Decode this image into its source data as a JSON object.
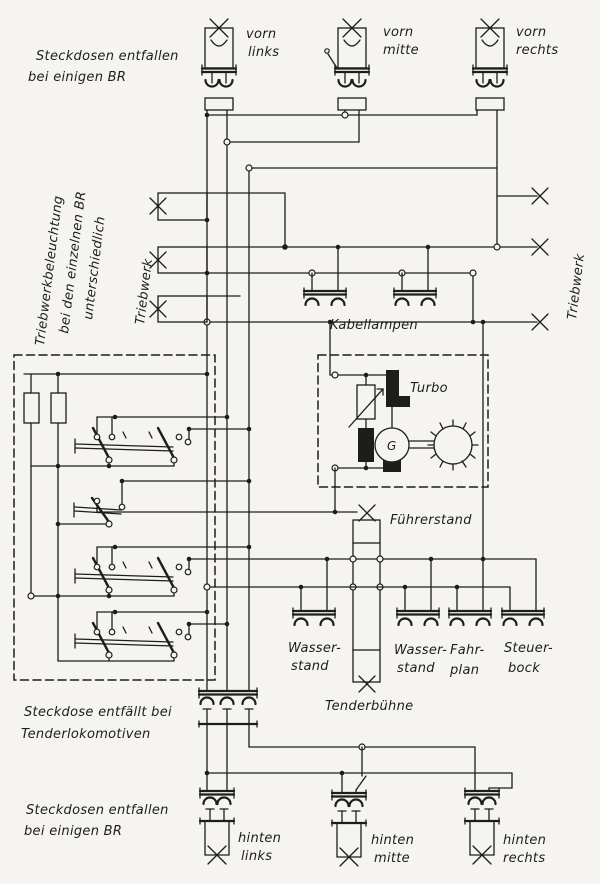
{
  "diagram": {
    "kind": "locomotive-lighting-wiring-schematic",
    "colors": {
      "ink": "#1d1d1b",
      "paper": "#f5f4f0"
    },
    "labels": {
      "note_top_left": [
        "Steckdosen entfallen",
        "bei einigen BR"
      ],
      "vorn_links": [
        "vorn",
        "links"
      ],
      "vorn_mitte": [
        "vorn",
        "mitte"
      ],
      "vorn_rechts": [
        "vorn",
        "rechts"
      ],
      "triebwerk_note": [
        "Triebwerkbeleuchtung",
        "bei den einzelnen BR",
        "unterschiedlich"
      ],
      "triebwerk_left": "Triebwerk",
      "triebwerk_right": "Triebwerk",
      "kabellampen": "Kabellampen",
      "turbo": "Turbo",
      "generator": "G",
      "fuehrerstand": "Führerstand",
      "wasserstand1": [
        "Wasser-",
        "stand"
      ],
      "wasserstand2": [
        "Wasser-",
        "stand"
      ],
      "fahrplan": [
        "Fahr-",
        "plan"
      ],
      "steuerbock": [
        "Steuer-",
        "bock"
      ],
      "tenderbuehne": "Tenderbühne",
      "note_tender": [
        "Steckdose entfällt bei",
        "Tenderlokomotiven"
      ],
      "note_bottom_left": [
        "Steckdosen entfallen",
        "bei einigen BR"
      ],
      "hinten_links": [
        "hinten",
        "links"
      ],
      "hinten_mitte": [
        "hinten",
        "mitte"
      ],
      "hinten_rechts": [
        "hinten",
        "rechts"
      ]
    }
  }
}
